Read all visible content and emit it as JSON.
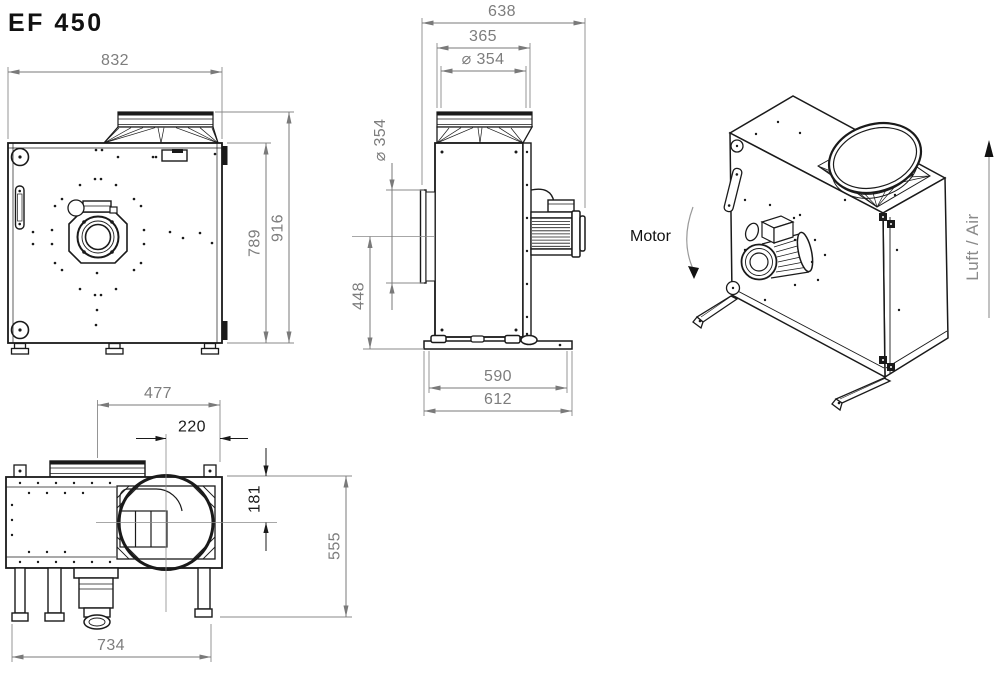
{
  "title": "EF 450",
  "colors": {
    "line": "#1a1a1a",
    "dim_line": "#7a7a7a",
    "dim_text": "#7d7d7d",
    "dim_dark": "#1a1a1a",
    "background": "#ffffff"
  },
  "front_view": {
    "label": "front view",
    "dims": {
      "width": "832",
      "body_height": "789",
      "total_height": "916"
    }
  },
  "side_view": {
    "label": "side view",
    "dims": {
      "total_depth": "638",
      "flange_width": "365",
      "spigot_diameter": "⌀ 354",
      "inlet_diameter": "⌀ 354",
      "inlet_center_height": "448",
      "base_inner_width": "590",
      "base_total_width": "612"
    }
  },
  "top_view": {
    "label": "top view",
    "dims": {
      "duct_center_to_edge": "477",
      "outlet_center_to_edge": "220",
      "outlet_center_offset": "181",
      "total_depth": "555",
      "feet_span": "734"
    }
  },
  "iso_view": {
    "motor_label": "Motor",
    "airflow_label": "Luft / Air"
  }
}
